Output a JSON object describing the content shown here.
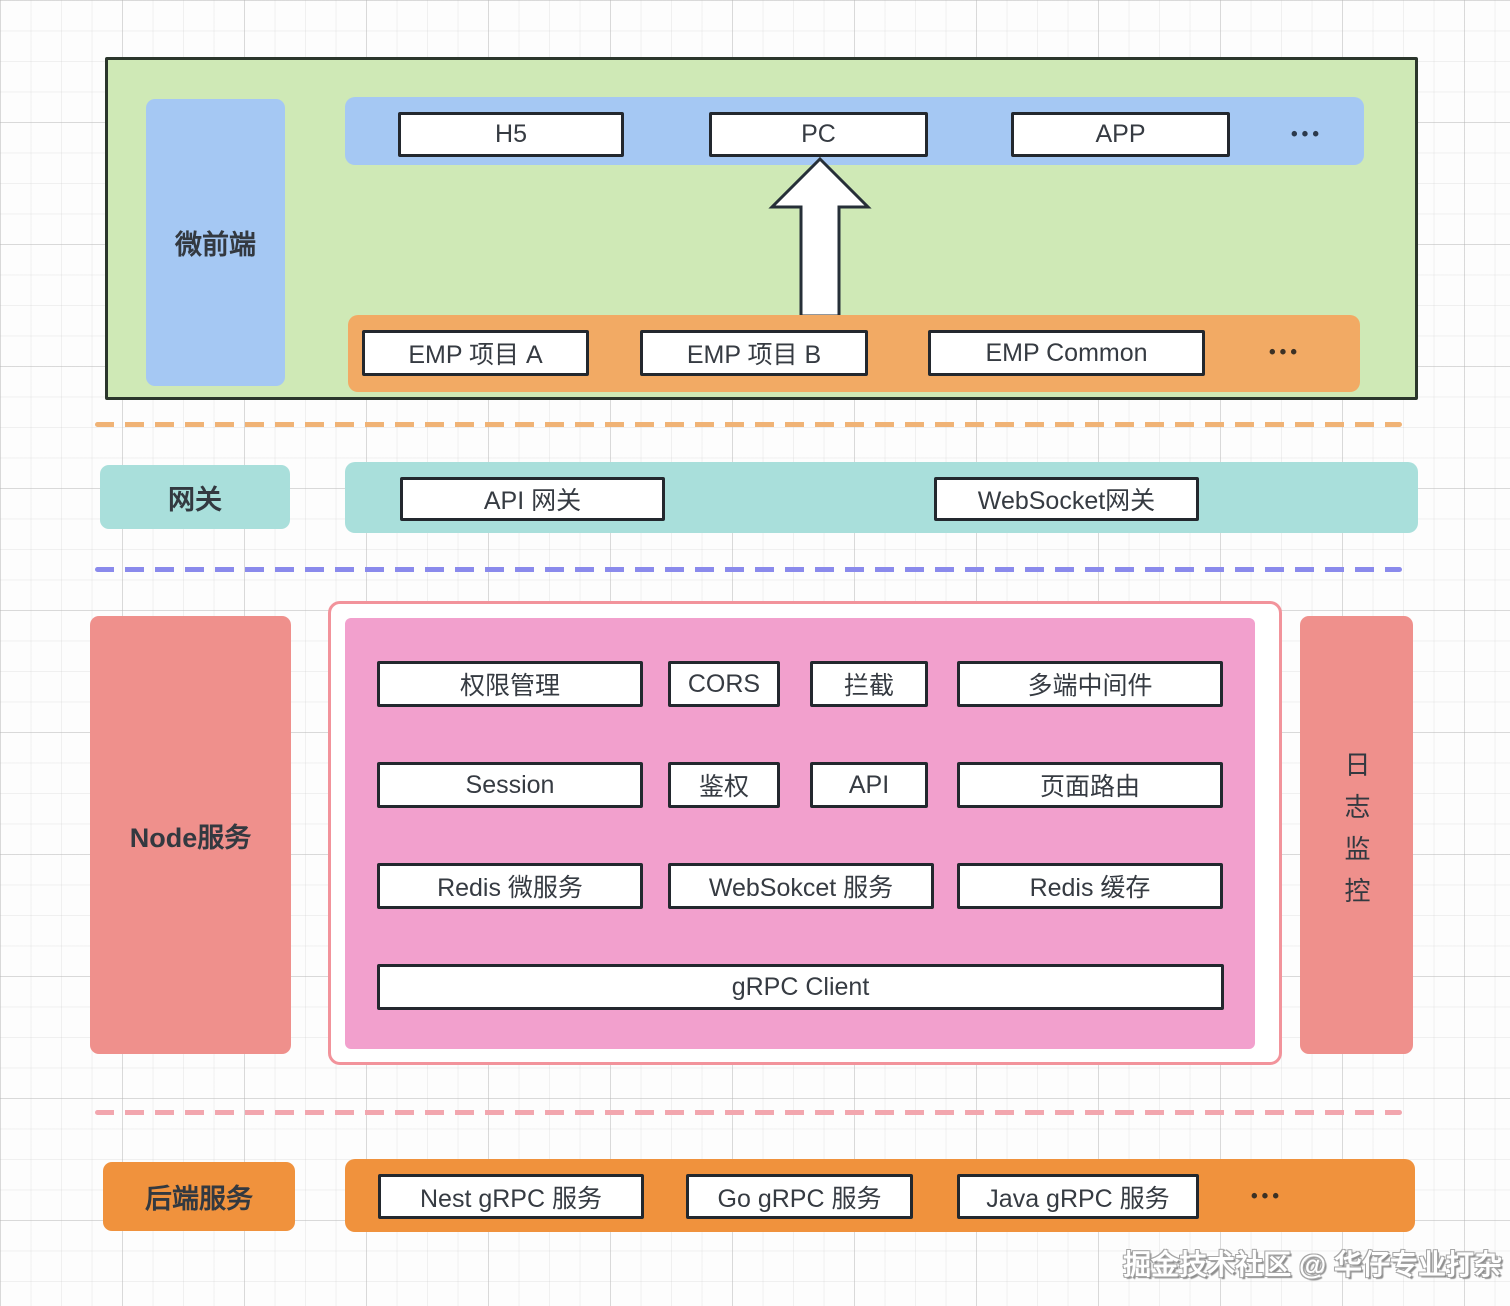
{
  "diagram": {
    "micro_frontend": {
      "label": "微前端",
      "clients": [
        "H5",
        "PC",
        "APP"
      ],
      "clients_more": "•••",
      "emp_modules": [
        "EMP 项目 A",
        "EMP 项目 B",
        "EMP Common"
      ],
      "emp_more": "•••"
    },
    "gateway": {
      "label": "网关",
      "items": [
        "API 网关",
        "WebSocket网关"
      ]
    },
    "node_layer": {
      "label": "Node服务",
      "middleware": [
        "权限管理",
        "CORS",
        "拦截",
        "多端中间件",
        "Session",
        "鉴权",
        "API",
        "页面路由",
        "Redis 微服务",
        "WebSokcet 服务",
        "Redis 缓存",
        "gRPC Client"
      ],
      "log_monitor": "日志监控"
    },
    "backend": {
      "label": "后端服务",
      "services": [
        "Nest gRPC 服务",
        "Go gRPC 服务",
        "Java gRPC 服务"
      ],
      "more": "•••"
    },
    "watermark": "掘金技术社区 @ 华仔专业打杂"
  },
  "colors": {
    "micro_frontend_bg": "#cfe9b6",
    "micro_frontend_border": "#2b362c",
    "client_band": "#a5c8f3",
    "emp_band": "#f2aa64",
    "gateway_band": "#a9dfdb",
    "node_side": "#ef908c",
    "node_inner": "#f2a0cd",
    "node_frame_border": "#f2939b",
    "backend_band": "#f0923d",
    "divider_orange": "#f0b376",
    "divider_purple": "#8a8aec",
    "divider_pink": "#f2a6ae",
    "box_border": "#23282e"
  }
}
